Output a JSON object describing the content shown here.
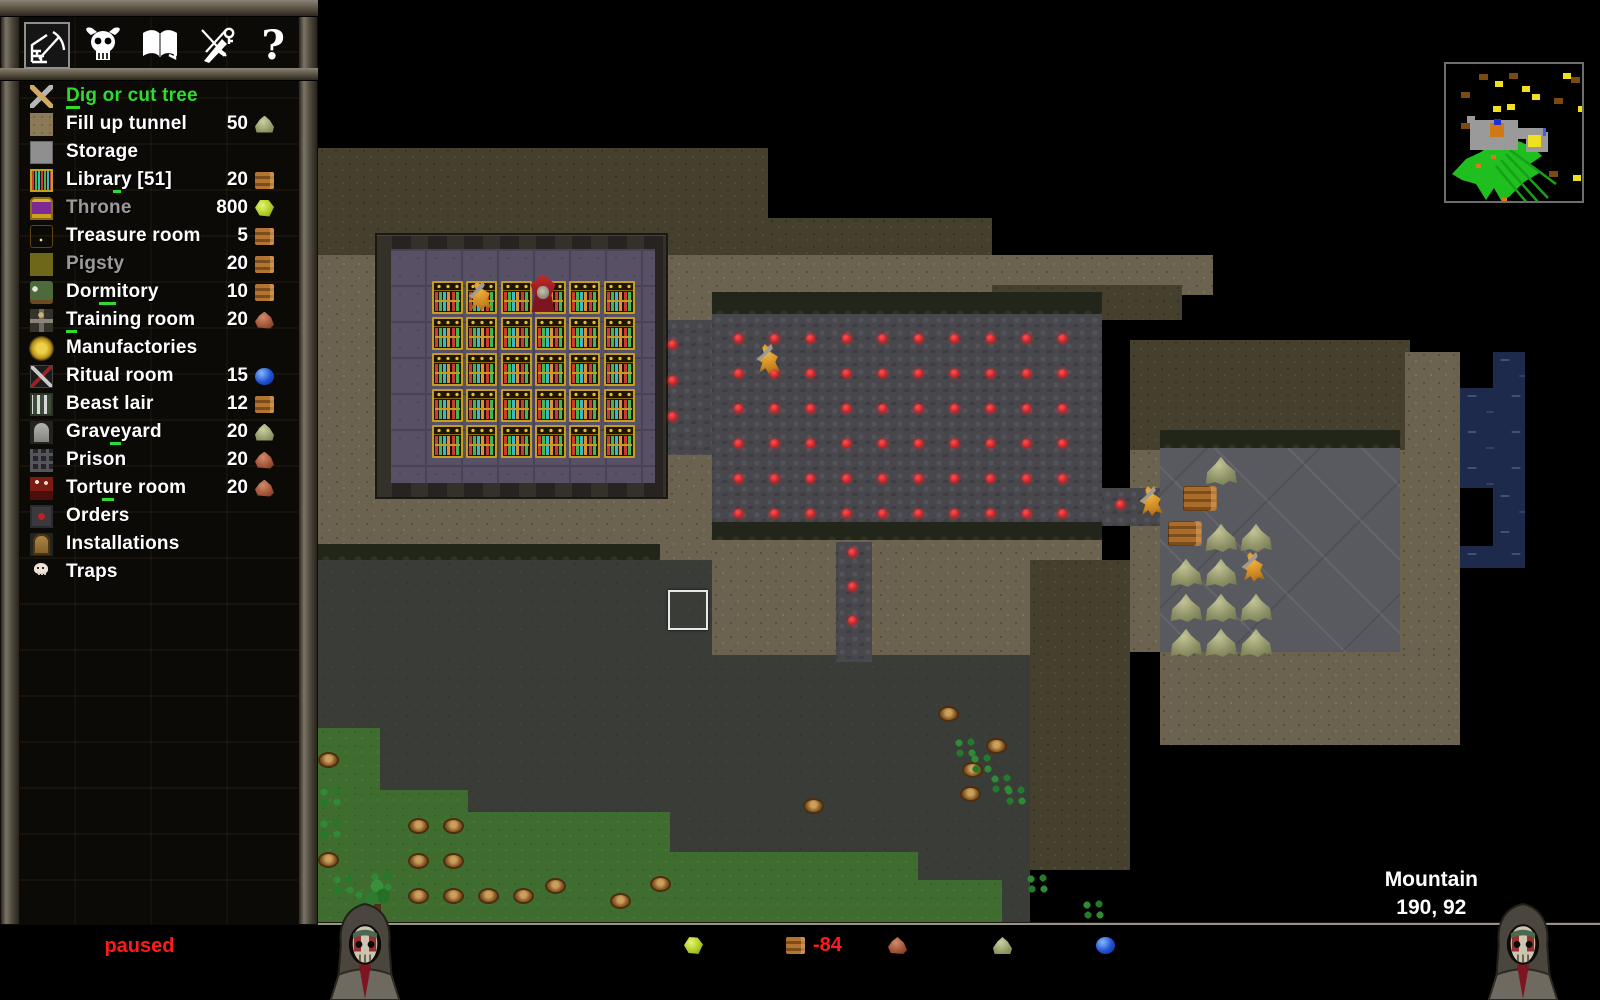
{
  "toolbar": {
    "items": [
      {
        "icon": "dig-wall-icon",
        "selected": true
      },
      {
        "icon": "horned-skull-icon",
        "selected": false
      },
      {
        "icon": "book-icon",
        "selected": false
      },
      {
        "icon": "dagger-key-icon",
        "selected": false
      },
      {
        "icon": "help-icon",
        "selected": false,
        "glyph": "?"
      }
    ]
  },
  "sidebar": {
    "items": [
      {
        "id": "dig",
        "label": "Dig or cut tree",
        "state": "selected",
        "hotkey": 0,
        "icon": "dig-icon"
      },
      {
        "id": "fill",
        "label": "Fill up tunnel",
        "cost": "50",
        "res": "rock",
        "icon": "fill-tunnel-icon"
      },
      {
        "id": "storage",
        "label": "Storage",
        "icon": "storage-icon"
      },
      {
        "id": "library",
        "label": "Library [51]",
        "cost": "20",
        "res": "wood",
        "hotkey": 5,
        "icon": "library-icon"
      },
      {
        "id": "throne",
        "label": "Throne",
        "cost": "800",
        "res": "gem",
        "state": "disabled",
        "icon": "throne-icon"
      },
      {
        "id": "treasure",
        "label": "Treasure room",
        "cost": "5",
        "res": "wood",
        "icon": "treasure-icon"
      },
      {
        "id": "pigsty",
        "label": "Pigsty",
        "cost": "20",
        "res": "wood",
        "state": "disabled",
        "icon": "pigsty-icon"
      },
      {
        "id": "dormitory",
        "label": "Dormitory",
        "cost": "10",
        "res": "wood",
        "hotkey": 3,
        "icon": "dormitory-icon"
      },
      {
        "id": "training",
        "label": "Training room",
        "cost": "20",
        "res": "iron",
        "hotkey": 0,
        "icon": "training-icon"
      },
      {
        "id": "manufactories",
        "label": "Manufactories",
        "icon": "manufactories-icon"
      },
      {
        "id": "ritual",
        "label": "Ritual room",
        "cost": "15",
        "res": "orb",
        "icon": "ritual-icon"
      },
      {
        "id": "beastlair",
        "label": "Beast lair",
        "cost": "12",
        "res": "wood",
        "icon": "beast-lair-icon"
      },
      {
        "id": "graveyard",
        "label": "Graveyard",
        "cost": "20",
        "res": "rock",
        "hotkey": 4,
        "icon": "graveyard-icon"
      },
      {
        "id": "prison",
        "label": "Prison",
        "cost": "20",
        "res": "iron",
        "icon": "prison-icon"
      },
      {
        "id": "torture",
        "label": "Torture room",
        "cost": "20",
        "res": "iron",
        "hotkey": 4,
        "icon": "torture-icon"
      },
      {
        "id": "orders",
        "label": "Orders",
        "icon": "orders-icon"
      },
      {
        "id": "installations",
        "label": "Installations",
        "icon": "installations-icon"
      },
      {
        "id": "traps",
        "label": "Traps",
        "icon": "traps-icon"
      }
    ],
    "selected_color": "#2edc2e"
  },
  "statusbar": {
    "speed_label": "speed:",
    "speed_value": "paused",
    "speed_value_color": "#ff1a1a",
    "fps": "FPS 59 / 47",
    "resources": [
      {
        "icon": "gem",
        "value": "0",
        "negative": false
      },
      {
        "icon": "wood",
        "value": "-84",
        "negative": true
      },
      {
        "icon": "iron",
        "value": "0",
        "negative": false
      },
      {
        "icon": "rock",
        "value": "705",
        "negative": false
      },
      {
        "icon": "orb",
        "value": "233",
        "negative": false
      }
    ],
    "turn": "T: 1297",
    "day": "day [203]",
    "population": "population: 1 / 10"
  },
  "location": {
    "name": "Mountain",
    "coords": "190, 92"
  },
  "map": {
    "regions": [
      [
        "dirt-dark",
        318,
        148,
        450,
        172
      ],
      [
        "dirt-dark",
        768,
        218,
        224,
        102
      ],
      [
        "dirt-light",
        318,
        255,
        394,
        305
      ],
      [
        "dirt-light",
        668,
        255,
        545,
        40
      ],
      [
        "dirt-dark",
        992,
        285,
        190,
        35
      ],
      [
        "dirt-light",
        668,
        295,
        44,
        202
      ],
      [
        "dirt-light",
        712,
        522,
        390,
        133
      ],
      [
        "dirt-dark",
        1130,
        340,
        280,
        110
      ],
      [
        "dirt-light",
        1405,
        352,
        55,
        130
      ],
      [
        "dirt-light",
        1130,
        450,
        30,
        202
      ],
      [
        "dirt-light",
        1400,
        450,
        60,
        202
      ],
      [
        "dirt-light",
        1160,
        652,
        300,
        93
      ],
      [
        "dirt-dark",
        1030,
        560,
        100,
        310
      ],
      [
        "gray-dirt",
        318,
        560,
        394,
        365
      ],
      [
        "gray-dirt",
        712,
        655,
        318,
        270
      ],
      [
        "wall-band",
        712,
        292,
        390,
        22
      ],
      [
        "wall-band",
        712,
        522,
        390,
        18
      ],
      [
        "wall-band",
        318,
        544,
        342,
        16
      ],
      [
        "wall-band",
        1160,
        430,
        240,
        18
      ],
      [
        "cobble",
        655,
        320,
        57,
        135
      ],
      [
        "cobble",
        712,
        314,
        390,
        208
      ],
      [
        "cobble",
        836,
        542,
        36,
        120
      ],
      [
        "cobble",
        1102,
        488,
        58,
        38
      ],
      [
        "storage-floor",
        1160,
        448,
        240,
        204
      ],
      [
        "water",
        1493,
        352,
        32,
        36
      ],
      [
        "water",
        1460,
        388,
        65,
        100
      ],
      [
        "water",
        1493,
        488,
        32,
        58
      ],
      [
        "water",
        1460,
        546,
        65,
        22
      ],
      [
        "grass",
        318,
        728,
        62,
        197
      ],
      [
        "grass",
        318,
        790,
        150,
        135
      ],
      [
        "grass",
        318,
        812,
        352,
        113
      ],
      [
        "grass",
        318,
        852,
        600,
        73
      ],
      [
        "grass",
        318,
        880,
        684,
        45
      ],
      [
        "library-border",
        375,
        233,
        293,
        266
      ],
      [
        "library-floor",
        391,
        249,
        264,
        234
      ]
    ],
    "red_dot_grids": [
      {
        "x": 734,
        "y": 334,
        "cols": 10,
        "rows": 6,
        "sx": 36,
        "sy": 35
      },
      {
        "x": 668,
        "y": 340,
        "cols": 1,
        "rows": 3,
        "sx": 36,
        "sy": 36
      },
      {
        "x": 848,
        "y": 548,
        "cols": 1,
        "rows": 3,
        "sx": 36,
        "sy": 34
      },
      {
        "x": 1116,
        "y": 500,
        "cols": 1,
        "rows": 1,
        "sx": 36,
        "sy": 36
      }
    ],
    "shelves": {
      "x": 432,
      "y": 281,
      "cols": 6,
      "rows": 5,
      "sx": 34.3,
      "sy": 36
    },
    "creatures": [
      {
        "type": "imp",
        "x": 467,
        "y": 281
      },
      {
        "type": "keeper",
        "x": 528,
        "y": 274
      },
      {
        "type": "imp",
        "x": 755,
        "y": 344
      },
      {
        "type": "imp",
        "x": 1138,
        "y": 486
      },
      {
        "type": "imp",
        "x": 1240,
        "y": 552
      }
    ],
    "rocks": [
      [
        1205,
        456
      ],
      [
        1205,
        523
      ],
      [
        1240,
        523
      ],
      [
        1170,
        558
      ],
      [
        1205,
        558
      ],
      [
        1170,
        593
      ],
      [
        1205,
        593
      ],
      [
        1240,
        593
      ],
      [
        1170,
        628
      ],
      [
        1205,
        628
      ],
      [
        1240,
        628
      ]
    ],
    "logs": [
      [
        1183,
        486
      ],
      [
        1168,
        521
      ]
    ],
    "stumps": [
      [
        408,
        818
      ],
      [
        443,
        818
      ],
      [
        408,
        853
      ],
      [
        443,
        853
      ],
      [
        408,
        888
      ],
      [
        443,
        888
      ],
      [
        478,
        888
      ],
      [
        513,
        888
      ],
      [
        318,
        752
      ],
      [
        318,
        852
      ],
      [
        545,
        878
      ],
      [
        610,
        893
      ],
      [
        650,
        876
      ],
      [
        803,
        798
      ],
      [
        938,
        706
      ],
      [
        962,
        762
      ],
      [
        986,
        738
      ],
      [
        960,
        786
      ]
    ],
    "clovers": [
      [
        317,
        785
      ],
      [
        317,
        817
      ],
      [
        330,
        873
      ],
      [
        352,
        888
      ],
      [
        368,
        870
      ],
      [
        952,
        736
      ],
      [
        968,
        752
      ],
      [
        988,
        772
      ],
      [
        1002,
        784
      ],
      [
        1024,
        872
      ],
      [
        1080,
        898
      ]
    ],
    "trees": [
      [
        360,
        878
      ]
    ],
    "selection": {
      "x": 668,
      "y": 590,
      "w": 36,
      "h": 36
    }
  },
  "minimap": {
    "structure_gray": [
      [
        24,
        56,
        48,
        30
      ],
      [
        56,
        64,
        44,
        11
      ],
      [
        80,
        68,
        22,
        20
      ],
      [
        21,
        52,
        8,
        8
      ]
    ],
    "orange_sq": [
      44,
      59,
      14,
      14
    ],
    "blue_dot": [
      48,
      55,
      7,
      6
    ],
    "yellow_sq": [
      82,
      71,
      13,
      12
    ],
    "blue_tick": [
      97,
      64,
      3,
      8
    ],
    "green_poly": "6,110 20,95 35,88 48,78 60,74 75,78 88,84 96,92 84,100 95,108 78,118 64,132 56,138 48,124 40,136 30,120 16,116",
    "streaks": [
      [
        60,
        90,
        102,
        134
      ],
      [
        55,
        96,
        92,
        138
      ],
      [
        50,
        102,
        82,
        140
      ],
      [
        64,
        86,
        110,
        120
      ]
    ],
    "brown_dots": [
      [
        33,
        10
      ],
      [
        63,
        9
      ],
      [
        15,
        28
      ],
      [
        108,
        34
      ],
      [
        125,
        13
      ],
      [
        103,
        107
      ],
      [
        15,
        59
      ]
    ],
    "yellow_dots": [
      [
        49,
        17
      ],
      [
        76,
        22
      ],
      [
        61,
        40
      ],
      [
        86,
        30
      ],
      [
        132,
        42
      ],
      [
        47,
        42
      ],
      [
        127,
        111
      ],
      [
        117,
        9
      ]
    ],
    "orange_dots": [
      [
        45,
        91
      ],
      [
        56,
        134
      ],
      [
        30,
        100
      ]
    ]
  }
}
